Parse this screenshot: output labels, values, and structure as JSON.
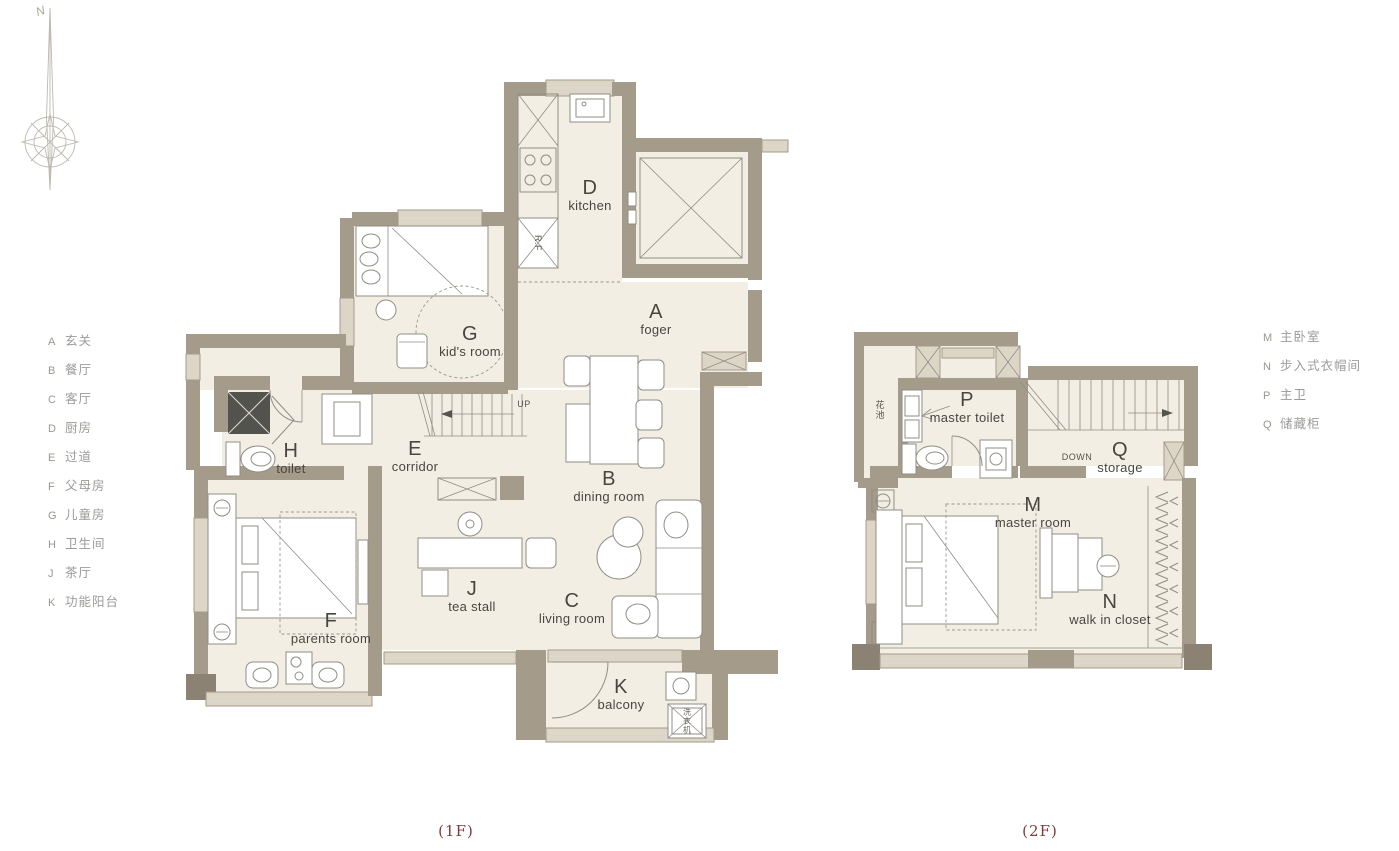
{
  "captions": {
    "floor1": "(1F)",
    "floor2": "(2F)"
  },
  "compass": {
    "north": "N"
  },
  "legend_left": {
    "items": [
      {
        "key": "A",
        "label": "玄关"
      },
      {
        "key": "B",
        "label": "餐厅"
      },
      {
        "key": "C",
        "label": "客厅"
      },
      {
        "key": "D",
        "label": "厨房"
      },
      {
        "key": "E",
        "label": "过道"
      },
      {
        "key": "F",
        "label": "父母房"
      },
      {
        "key": "G",
        "label": "儿童房"
      },
      {
        "key": "H",
        "label": "卫生间"
      },
      {
        "key": "J",
        "label": "茶厅"
      },
      {
        "key": "K",
        "label": "功能阳台"
      }
    ]
  },
  "legend_right": {
    "items": [
      {
        "key": "M",
        "label": "主卧室"
      },
      {
        "key": "N",
        "label": "步入式衣帽间"
      },
      {
        "key": "P",
        "label": "主卫"
      },
      {
        "key": "Q",
        "label": "储藏柜"
      }
    ]
  },
  "floor1": {
    "rooms": [
      {
        "key": "D",
        "name": "kitchen"
      },
      {
        "key": "A",
        "name": "foger"
      },
      {
        "key": "G",
        "name": "kid's room"
      },
      {
        "key": "E",
        "name": "corridor"
      },
      {
        "key": "H",
        "name": "toilet"
      },
      {
        "key": "B",
        "name": "dining room"
      },
      {
        "key": "J",
        "name": "tea stall"
      },
      {
        "key": "C",
        "name": "living room"
      },
      {
        "key": "F",
        "name": "parents room"
      },
      {
        "key": "K",
        "name": "balcony"
      }
    ],
    "annotations": {
      "up": "UP",
      "fridge": "R.F",
      "washer": "洗衣机"
    }
  },
  "floor2": {
    "rooms": [
      {
        "key": "P",
        "name": "master toilet"
      },
      {
        "key": "Q",
        "name": "storage"
      },
      {
        "key": "M",
        "name": "master room"
      },
      {
        "key": "N",
        "name": "walk in closet"
      }
    ],
    "annotations": {
      "down": "DOWN",
      "planter": "花池"
    }
  },
  "colors": {
    "wall": "#a49b8a",
    "wall_dark": "#8b8273",
    "cabinet_dark": "#53534d",
    "floor": "#f3eee3",
    "window": "#ddd6c7",
    "line": "#8f8d86",
    "label_text": "#47463f",
    "legend_text": "#9b9b99",
    "caption_text": "#7e3b3b",
    "background": "#ffffff"
  }
}
